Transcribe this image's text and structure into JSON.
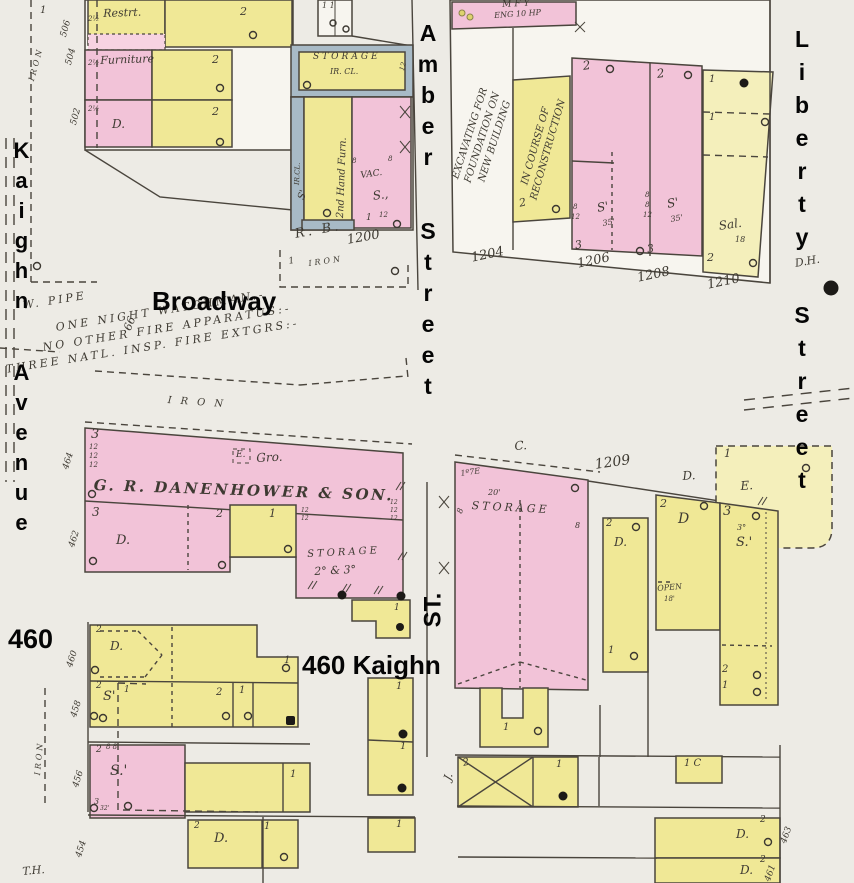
{
  "title": "Sanborn fire insurance map — Kaighn Avenue, Broadway, Amber Street and Liberty Street blocks",
  "colors": {
    "background": "#edebe5",
    "building_pink": "#f2c3d8",
    "building_yellow": "#f0e896",
    "building_pale_yellow": "#f4efbb",
    "iron_clad_gray": "#a8bac6",
    "line": "#4a453d",
    "overlay_text": "#050505",
    "map_text": "#3e3a32"
  },
  "street_labels": {
    "kaighn_avenue": "Kaighn Avenue",
    "broadway": "Broadway",
    "amber_street": "Amber Street",
    "liberty_street": "Liberty Street",
    "st_abbrev": "ST.",
    "lot_460": "460",
    "lot_460_kaighn": "460 Kaighn"
  },
  "annotations": [
    {
      "text": "1",
      "x": 40,
      "y": 6,
      "size": 10
    },
    {
      "text": "IRON",
      "x": 28,
      "y": 80,
      "rot": -75,
      "size": 8,
      "cls": "spaced"
    },
    {
      "text": "506",
      "x": 60,
      "y": 36,
      "rot": -75,
      "size": 9
    },
    {
      "text": "504",
      "x": 65,
      "y": 64,
      "rot": -75,
      "size": 9
    },
    {
      "text": "502",
      "x": 70,
      "y": 124,
      "rot": -75,
      "size": 9
    },
    {
      "text": "2½",
      "x": 88,
      "y": 16,
      "size": 7
    },
    {
      "text": "2½",
      "x": 88,
      "y": 60,
      "size": 7
    },
    {
      "text": "2½",
      "x": 88,
      "y": 106,
      "size": 7
    },
    {
      "text": "Restrt.",
      "x": 103,
      "y": 8,
      "rot": -2,
      "size": 11
    },
    {
      "text": "2",
      "x": 240,
      "y": 6,
      "size": 11
    },
    {
      "text": "1  1",
      "x": 322,
      "y": 2,
      "size": 8
    },
    {
      "text": "Furniture",
      "x": 100,
      "y": 55,
      "rot": -2,
      "size": 11
    },
    {
      "text": "2",
      "x": 212,
      "y": 54,
      "size": 11
    },
    {
      "text": "2",
      "x": 212,
      "y": 106,
      "size": 11
    },
    {
      "text": "D.",
      "x": 112,
      "y": 118,
      "size": 12
    },
    {
      "text": "STORAGE",
      "x": 313,
      "y": 53,
      "size": 9,
      "cls": "spaced"
    },
    {
      "text": "IR. CL.",
      "x": 330,
      "y": 68,
      "size": 8
    },
    {
      "text": "12",
      "x": 399,
      "y": 70,
      "rot": -75,
      "size": 7
    },
    {
      "text": "2nd Hand Furn.",
      "x": 336,
      "y": 218,
      "rot": -88,
      "size": 10
    },
    {
      "text": "IR.CL.",
      "x": 294,
      "y": 185,
      "rot": -88,
      "size": 7
    },
    {
      "text": "S'",
      "x": 297,
      "y": 198,
      "rot": -70,
      "size": 10
    },
    {
      "text": "8",
      "x": 352,
      "y": 158,
      "size": 7
    },
    {
      "text": "8",
      "x": 388,
      "y": 156,
      "size": 7
    },
    {
      "text": "VAC.",
      "x": 360,
      "y": 172,
      "rot": -8,
      "size": 9
    },
    {
      "text": "S.,",
      "x": 372,
      "y": 190,
      "rot": -8,
      "size": 12
    },
    {
      "text": "1",
      "x": 366,
      "y": 214,
      "size": 9
    },
    {
      "text": "12",
      "x": 379,
      "y": 212,
      "size": 7
    },
    {
      "text": "R. B.",
      "x": 294,
      "y": 228,
      "rot": -10,
      "size": 13,
      "cls": "spaced"
    },
    {
      "text": "1200",
      "x": 346,
      "y": 234,
      "rot": -10,
      "size": 13
    },
    {
      "text": "1",
      "x": 288,
      "y": 258,
      "rot": -10,
      "size": 9
    },
    {
      "text": "IRON",
      "x": 308,
      "y": 260,
      "rot": -8,
      "size": 8,
      "cls": "spaced"
    },
    {
      "text": "MFY",
      "x": 502,
      "y": 1,
      "rot": -3,
      "size": 9,
      "cls": "spaced"
    },
    {
      "text": "ENG 10 HP",
      "x": 494,
      "y": 12,
      "rot": -4,
      "size": 8
    },
    {
      "text": "EXCAVATING FOR\nFOUNDATION ON\nNEW BUILDING",
      "x": 395,
      "y": 118,
      "rot": -72,
      "size": 10,
      "cls": "rotblock"
    },
    {
      "text": "IN COURSE OF\nRECONSTRUCTION",
      "x": 462,
      "y": 135,
      "rot": -74,
      "size": 10,
      "cls": "rotblock2"
    },
    {
      "text": "2",
      "x": 518,
      "y": 198,
      "rot": -12,
      "size": 11
    },
    {
      "text": "2",
      "x": 582,
      "y": 60,
      "rot": -8,
      "size": 12
    },
    {
      "text": "2",
      "x": 656,
      "y": 68,
      "rot": -8,
      "size": 12
    },
    {
      "text": "8",
      "x": 573,
      "y": 204,
      "size": 7
    },
    {
      "text": "12",
      "x": 571,
      "y": 214,
      "size": 7
    },
    {
      "text": "S'",
      "x": 596,
      "y": 202,
      "rot": -10,
      "size": 12
    },
    {
      "text": "35'",
      "x": 602,
      "y": 220,
      "rot": -10,
      "size": 8
    },
    {
      "text": "8",
      "x": 645,
      "y": 192,
      "size": 7
    },
    {
      "text": "8",
      "x": 645,
      "y": 202,
      "size": 7
    },
    {
      "text": "12",
      "x": 643,
      "y": 212,
      "size": 7
    },
    {
      "text": "S'",
      "x": 666,
      "y": 198,
      "rot": -10,
      "size": 12
    },
    {
      "text": "35'",
      "x": 670,
      "y": 216,
      "rot": -10,
      "size": 8
    },
    {
      "text": "3",
      "x": 574,
      "y": 240,
      "rot": -10,
      "size": 11
    },
    {
      "text": "3",
      "x": 646,
      "y": 244,
      "rot": -10,
      "size": 11
    },
    {
      "text": "1",
      "x": 709,
      "y": 75,
      "size": 10
    },
    {
      "text": "1",
      "x": 709,
      "y": 113,
      "size": 10
    },
    {
      "text": "Sal.",
      "x": 718,
      "y": 220,
      "rot": -8,
      "size": 12
    },
    {
      "text": "18",
      "x": 735,
      "y": 236,
      "size": 8
    },
    {
      "text": "2",
      "x": 707,
      "y": 252,
      "size": 11
    },
    {
      "text": "1204",
      "x": 470,
      "y": 252,
      "rot": -12,
      "size": 13
    },
    {
      "text": "1206",
      "x": 576,
      "y": 258,
      "rot": -12,
      "size": 13
    },
    {
      "text": "1208",
      "x": 636,
      "y": 272,
      "rot": -12,
      "size": 13
    },
    {
      "text": "1210",
      "x": 706,
      "y": 279,
      "rot": -12,
      "size": 13
    },
    {
      "text": "D.H.",
      "x": 794,
      "y": 258,
      "rot": -10,
      "size": 11
    },
    {
      "text": "W. PIPE",
      "x": 22,
      "y": 300,
      "rot": -9,
      "size": 11,
      "cls": "spaced"
    },
    {
      "text": "66",
      "x": 122,
      "y": 328,
      "rot": -68,
      "size": 11
    },
    {
      "text": "ONE NIGHT WATCHMAN.-",
      "x": 55,
      "y": 322,
      "rot": -9,
      "size": 11,
      "cls": "spaced"
    },
    {
      "text": "NO OTHER FIRE APPARATUS:-",
      "x": 42,
      "y": 342,
      "rot": -9,
      "size": 11,
      "cls": "spaced"
    },
    {
      "text": "THREE NATL. INSP. FIRE EXTGRS:-",
      "x": 5,
      "y": 364,
      "rot": -9,
      "size": 11,
      "cls": "spaced"
    },
    {
      "text": "IRON",
      "x": 168,
      "y": 396,
      "rot": 4,
      "size": 10,
      "cls": "wspaced"
    },
    {
      "text": "3",
      "x": 91,
      "y": 428,
      "size": 13
    },
    {
      "text": "12",
      "x": 89,
      "y": 444,
      "size": 7
    },
    {
      "text": "12",
      "x": 89,
      "y": 453,
      "size": 7
    },
    {
      "text": "12",
      "x": 89,
      "y": 462,
      "size": 7
    },
    {
      "text": "E.",
      "x": 236,
      "y": 451,
      "size": 9
    },
    {
      "text": "Gro.",
      "x": 256,
      "y": 452,
      "rot": -3,
      "size": 12
    },
    {
      "text": "G. R. DANENHOWER & SON.",
      "x": 94,
      "y": 478,
      "rot": 2,
      "size": 15,
      "cls": "caps"
    },
    {
      "text": "3",
      "x": 92,
      "y": 506,
      "size": 12
    },
    {
      "text": "2",
      "x": 216,
      "y": 508,
      "size": 11
    },
    {
      "text": "1",
      "x": 269,
      "y": 508,
      "size": 11
    },
    {
      "text": "12",
      "x": 301,
      "y": 508,
      "size": 6
    },
    {
      "text": "12",
      "x": 301,
      "y": 516,
      "size": 6
    },
    {
      "text": "12",
      "x": 390,
      "y": 500,
      "size": 6
    },
    {
      "text": "12",
      "x": 390,
      "y": 508,
      "size": 6
    },
    {
      "text": "12",
      "x": 390,
      "y": 516,
      "size": 6
    },
    {
      "text": "D.",
      "x": 116,
      "y": 534,
      "size": 13
    },
    {
      "text": "STORAGE",
      "x": 307,
      "y": 550,
      "rot": -3,
      "size": 10,
      "cls": "spaced"
    },
    {
      "text": "2° & 3°",
      "x": 314,
      "y": 566,
      "rot": -3,
      "size": 11
    },
    {
      "text": "464",
      "x": 62,
      "y": 468,
      "rot": -72,
      "size": 9
    },
    {
      "text": "462",
      "x": 68,
      "y": 546,
      "rot": -72,
      "size": 9
    },
    {
      "text": "460",
      "x": 66,
      "y": 666,
      "rot": -72,
      "size": 9
    },
    {
      "text": "458",
      "x": 70,
      "y": 716,
      "rot": -72,
      "size": 9
    },
    {
      "text": "456",
      "x": 72,
      "y": 786,
      "rot": -72,
      "size": 9
    },
    {
      "text": "454",
      "x": 75,
      "y": 856,
      "rot": -72,
      "size": 9
    },
    {
      "text": "2",
      "x": 96,
      "y": 626,
      "size": 9
    },
    {
      "text": "D.",
      "x": 110,
      "y": 640,
      "size": 12
    },
    {
      "text": "2",
      "x": 96,
      "y": 682,
      "size": 9
    },
    {
      "text": "S'",
      "x": 103,
      "y": 690,
      "size": 13
    },
    {
      "text": "2",
      "x": 216,
      "y": 688,
      "size": 10
    },
    {
      "text": "1",
      "x": 239,
      "y": 686,
      "size": 10
    },
    {
      "text": "1",
      "x": 284,
      "y": 656,
      "size": 10
    },
    {
      "text": "2",
      "x": 96,
      "y": 746,
      "size": 9
    },
    {
      "text": "8 8",
      "x": 106,
      "y": 744,
      "size": 7
    },
    {
      "text": "S.'",
      "x": 110,
      "y": 764,
      "size": 14
    },
    {
      "text": "3",
      "x": 94,
      "y": 798,
      "size": 8
    },
    {
      "text": "32'",
      "x": 100,
      "y": 806,
      "size": 6
    },
    {
      "text": "1",
      "x": 290,
      "y": 770,
      "size": 10
    },
    {
      "text": "2",
      "x": 194,
      "y": 822,
      "size": 9
    },
    {
      "text": "D.",
      "x": 214,
      "y": 832,
      "size": 13
    },
    {
      "text": "1",
      "x": 264,
      "y": 822,
      "size": 10
    },
    {
      "text": "1",
      "x": 396,
      "y": 820,
      "size": 10
    },
    {
      "text": "T.H.",
      "x": 22,
      "y": 866,
      "rot": -5,
      "size": 11
    },
    {
      "text": "IRON",
      "x": 34,
      "y": 775,
      "rot": -85,
      "size": 8,
      "cls": "spaced"
    },
    {
      "text": "1",
      "x": 124,
      "y": 686,
      "size": 9
    },
    {
      "text": "1",
      "x": 394,
      "y": 604,
      "size": 9
    },
    {
      "text": "1",
      "x": 396,
      "y": 682,
      "size": 10
    },
    {
      "text": "1",
      "x": 400,
      "y": 742,
      "size": 10
    },
    {
      "text": "C.",
      "x": 514,
      "y": 440,
      "rot": -4,
      "size": 12
    },
    {
      "text": "1209",
      "x": 594,
      "y": 458,
      "rot": -8,
      "size": 14
    },
    {
      "text": "D.",
      "x": 682,
      "y": 470,
      "rot": -4,
      "size": 12
    },
    {
      "text": "E.",
      "x": 740,
      "y": 480,
      "rot": -4,
      "size": 12
    },
    {
      "text": "1º7E",
      "x": 460,
      "y": 470,
      "rot": -8,
      "size": 8
    },
    {
      "text": "20'",
      "x": 488,
      "y": 489,
      "size": 8
    },
    {
      "text": "STORAGE",
      "x": 472,
      "y": 500,
      "rot": 3,
      "size": 11,
      "cls": "spaced"
    },
    {
      "text": "8",
      "x": 456,
      "y": 512,
      "rot": -70,
      "size": 8
    },
    {
      "text": "8",
      "x": 575,
      "y": 522,
      "size": 8
    },
    {
      "text": "1",
      "x": 724,
      "y": 448,
      "size": 11
    },
    {
      "text": "2",
      "x": 606,
      "y": 519,
      "size": 10
    },
    {
      "text": "D.",
      "x": 614,
      "y": 536,
      "size": 12
    },
    {
      "text": "1",
      "x": 608,
      "y": 646,
      "size": 10
    },
    {
      "text": "2",
      "x": 660,
      "y": 498,
      "size": 11
    },
    {
      "text": "D",
      "x": 678,
      "y": 512,
      "size": 14
    },
    {
      "text": "OPEN",
      "x": 657,
      "y": 585,
      "rot": -5,
      "size": 8
    },
    {
      "text": "18'",
      "x": 664,
      "y": 596,
      "size": 7
    },
    {
      "text": "3",
      "x": 723,
      "y": 505,
      "size": 13
    },
    {
      "text": "3°",
      "x": 737,
      "y": 524,
      "size": 8
    },
    {
      "text": "S.'",
      "x": 736,
      "y": 536,
      "size": 13
    },
    {
      "text": "2",
      "x": 722,
      "y": 665,
      "size": 10
    },
    {
      "text": "1",
      "x": 722,
      "y": 681,
      "size": 10
    },
    {
      "text": "1",
      "x": 503,
      "y": 723,
      "size": 10
    },
    {
      "text": "J.",
      "x": 442,
      "y": 778,
      "rot": -70,
      "size": 11
    },
    {
      "text": "2",
      "x": 462,
      "y": 759,
      "rot": -12,
      "size": 10
    },
    {
      "text": "1",
      "x": 556,
      "y": 760,
      "size": 10
    },
    {
      "text": "1 C",
      "x": 684,
      "y": 759,
      "size": 10
    },
    {
      "text": "D.",
      "x": 736,
      "y": 828,
      "size": 12
    },
    {
      "text": "2",
      "x": 760,
      "y": 816,
      "size": 9
    },
    {
      "text": "D.",
      "x": 740,
      "y": 864,
      "size": 12
    },
    {
      "text": "2",
      "x": 760,
      "y": 856,
      "size": 9
    },
    {
      "text": "463",
      "x": 780,
      "y": 842,
      "rot": -70,
      "size": 9
    },
    {
      "text": "461",
      "x": 764,
      "y": 880,
      "rot": -70,
      "size": 9
    }
  ]
}
